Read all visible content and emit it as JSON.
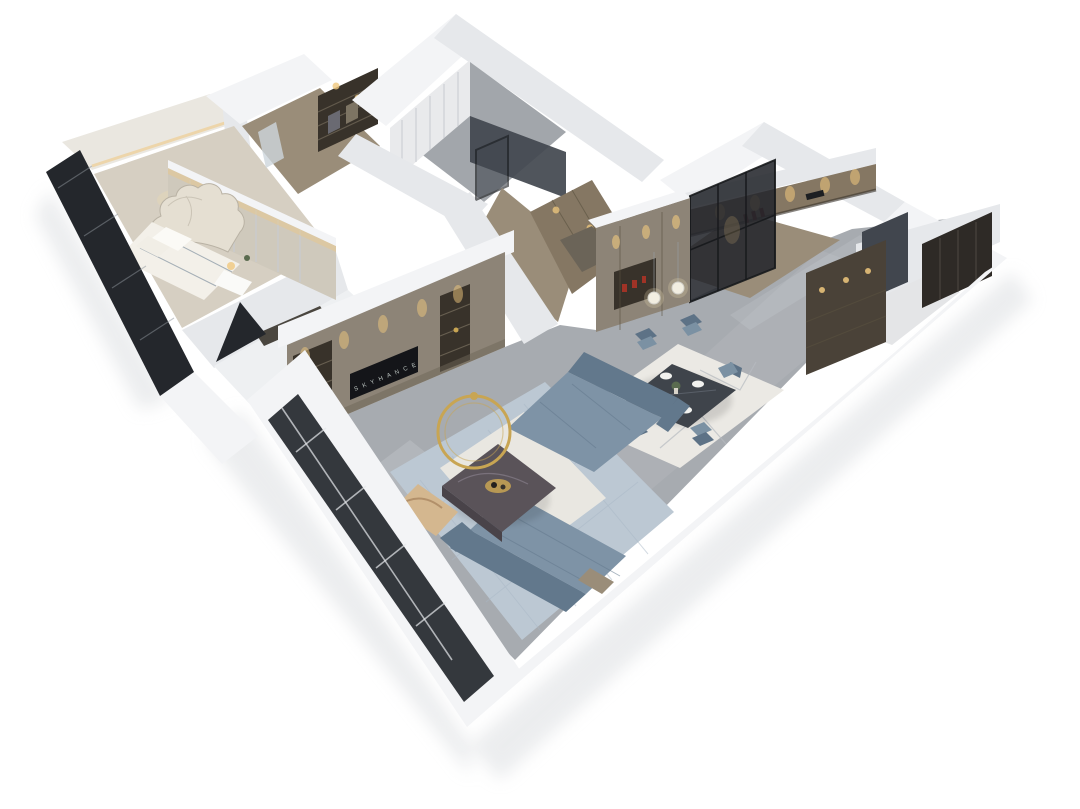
{
  "scene": {
    "type": "3d-isometric-floorplan-render",
    "background": "#ffffff",
    "rooms": [
      "master-bedroom",
      "walk-in-closet",
      "bathroom",
      "hallway",
      "kitchen",
      "entry-foyer",
      "dining-area",
      "living-room",
      "secondary-bedroom"
    ],
    "furniture": [
      "double-bed",
      "upholstered-headboard",
      "nightstand",
      "table-lamp",
      "closet-shelving",
      "sheer-curtain",
      "shower-glass-panel",
      "floor-drain",
      "hallway-wardrobe",
      "kitchen-cabinets",
      "wine-bottles",
      "range-hood",
      "black-frame-glass-partition",
      "entry-door",
      "display-cabinet",
      "dining-table",
      "dining-chairs-x6",
      "plates",
      "plant-centerpiece",
      "pendant-globe-lights",
      "dining-rug",
      "tv-media-wall",
      "television",
      "downlights",
      "living-rug",
      "inner-rug",
      "sofa-top",
      "sofa-bottom",
      "marble-coffee-table",
      "gold-ring-decor",
      "tan-accent-chair",
      "side-table",
      "floor-to-ceiling-windows"
    ]
  },
  "tv": {
    "logo": "S K Y H A N C E"
  },
  "colors": {
    "bg": "#ffffff",
    "wallTop": "#f3f4f6",
    "wallFace": "#e6e8eb",
    "wallShade": "#cfd3d8",
    "shadowGray": "#d9dcdf",
    "floorMarble": "#a7abb0",
    "floorVein": "#c9ccd0",
    "floorWarm": "#d6cfc2",
    "floorTile": "#a2a6ab",
    "floorBright": "#eef0f2",
    "woodWarm": "#9a8d79",
    "cabinetWarm": "#857763",
    "cabinetTaupe": "#8d8477",
    "cabinetDark": "#6e6557",
    "shelfDark": "#38322a",
    "bronzeDark": "#4a4238",
    "doorDark": "#2e2a26",
    "glassDark": "#24272c",
    "glassMid": "#41464e",
    "tvBlack": "#141519",
    "glow": "#f0c87e",
    "glowSoft": "#ecdbb2",
    "marbleWall": "#eae7e0",
    "curtainSheer": "#e9eaec",
    "curtainStripe": "#c9ccd1",
    "headboardWall": "#cfc9bc",
    "bedCream": "#e5dfd2",
    "bedWhite": "#f3f0e9",
    "sofaBlue": "#7e93a6",
    "sofaBlueDark": "#62788c",
    "rugLiving": "#bcc8d3",
    "rugInner": "#e9e7e1",
    "rugDining": "#ebe9e4",
    "rugPattern": "#b6bac0",
    "tableDark": "#3f444b",
    "chairBlue": "#7b91a3",
    "chairBlueDark": "#5d7286",
    "coffeeTable": "#5a5359",
    "gold": "#c8a553",
    "accentTan": "#d4b78f",
    "accentRed": "#a03326",
    "plantGreen": "#5a6b4f"
  }
}
